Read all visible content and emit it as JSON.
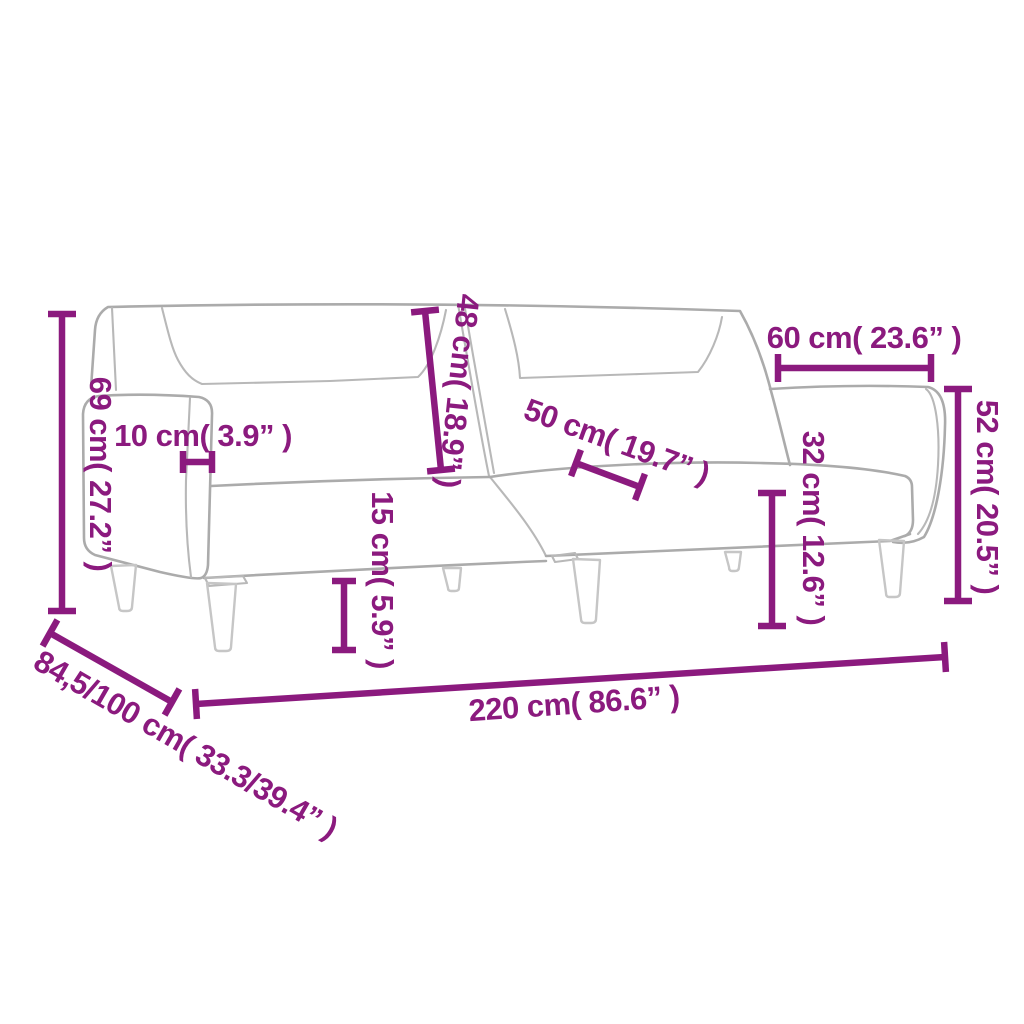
{
  "measurements": {
    "total_height": "69 cm( 27.2” )",
    "armrest_width": "10 cm( 3.9” )",
    "backrest_height": "48 cm( 18.9” )",
    "seat_depth": "50 cm( 19.7” )",
    "right_section_width": "60 cm( 23.6” )",
    "right_section_height": "52 cm( 20.5” )",
    "seat_height": "32 cm( 12.6” )",
    "leg_height": "15 cm( 5.9” )",
    "total_width": "220 cm( 86.6” )",
    "depth_range": "84,5/100 cm( 33.3/39.4” )"
  },
  "colors": {
    "dimension_accent": "#8B1A7E",
    "outline_gray": "#ABABAB",
    "outline_light_gray": "#B8B8B8",
    "leg_gray": "#C6C6C6",
    "background": "#FFFFFF"
  }
}
